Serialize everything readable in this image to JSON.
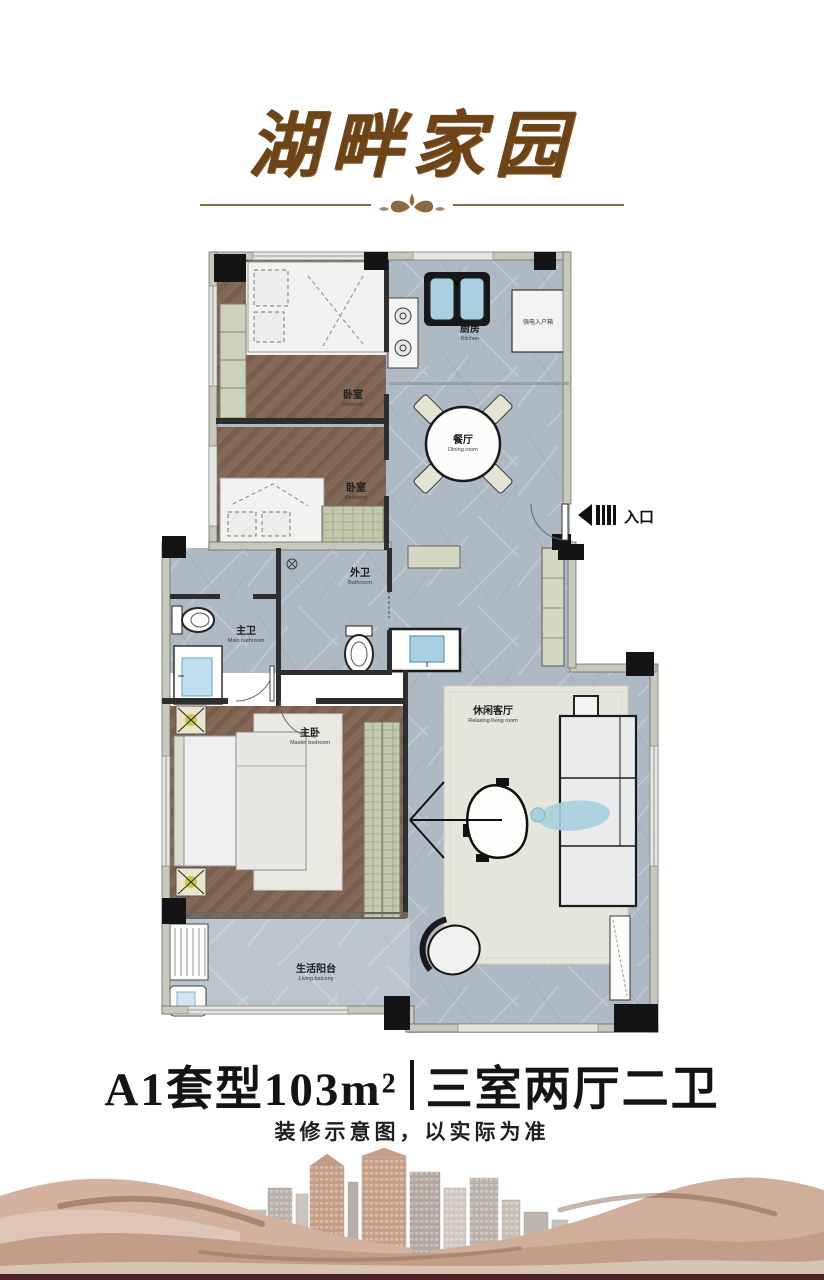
{
  "header": {
    "title": "湖畔家园"
  },
  "floor_plan": {
    "entrance_label": "入口",
    "electric_box_label": "强电入户箱",
    "rooms": [
      {
        "id": "bedroom-1",
        "zh": "卧室",
        "en": "Bedroom"
      },
      {
        "id": "bedroom-2",
        "zh": "卧室",
        "en": "Bedroom"
      },
      {
        "id": "kitchen",
        "zh": "厨房",
        "en": "Kitchen"
      },
      {
        "id": "dining-room",
        "zh": "餐厅",
        "en": "Dining room"
      },
      {
        "id": "guest-bathroom",
        "zh": "外卫",
        "en": "Bathroom"
      },
      {
        "id": "master-bathroom",
        "zh": "主卫",
        "en": "Main bathroom"
      },
      {
        "id": "master-bedroom",
        "zh": "主卧",
        "en": "Master bedroom"
      },
      {
        "id": "living-room",
        "zh": "休闲客厅",
        "en": "Relaxing living room"
      },
      {
        "id": "living-balcony",
        "zh": "生活阳台",
        "en": "Living balcony"
      }
    ]
  },
  "unit_info": {
    "model": "A1套型103m²",
    "separator": "|",
    "layout": "三室两厅二卫",
    "disclaimer": "装修示意图，以实际为准"
  },
  "colors": {
    "accent_brown": "#6d4318",
    "wall_light": "#c6c9bb",
    "pillar_black": "#141414",
    "floor_marble": "#adb9c3",
    "floor_wood": "#81665a",
    "fixture_blue": "#a9cfe2",
    "sand_tan": "#c29d88",
    "bottom_strip": "#4e2220"
  }
}
